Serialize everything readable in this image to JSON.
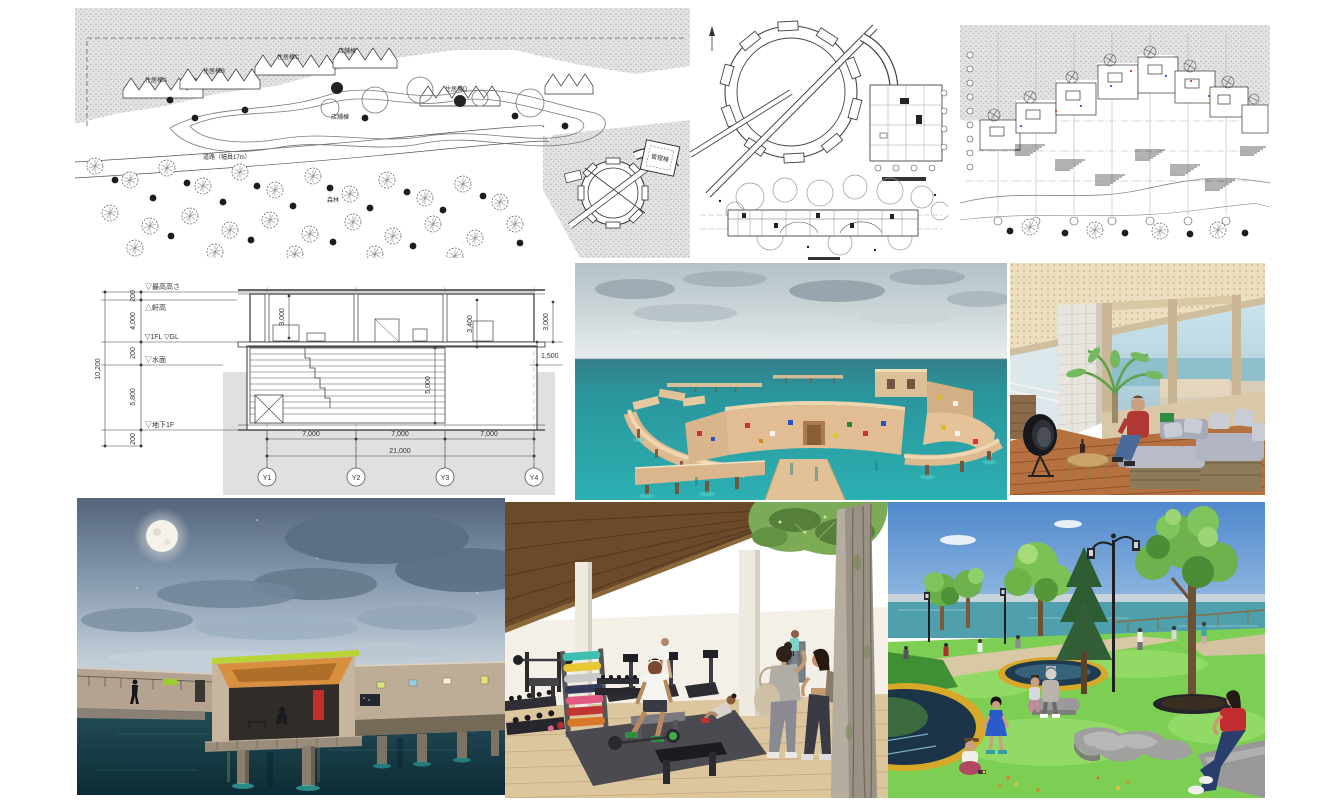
{
  "palette": {
    "sea_teal": "#2aa7ab",
    "night_water": "#123b44",
    "roof_lime": "#b9d437",
    "roof_orange": "#d89040",
    "grass_green": "#7ccf52",
    "drawing_ink": "#333333",
    "ground_gray": "#e0e0e0"
  },
  "site_plan": {
    "labels": {
      "building_a": "住居棟A",
      "building_b": "住居棟B",
      "building_c": "住居棟C",
      "building_d": "住居棟D",
      "shop": "店舗棟",
      "shop2": "店舗棟",
      "road": "道路（幅員17m）",
      "forest": "森林",
      "admin": "管理棟"
    }
  },
  "section": {
    "levels": {
      "max_height": "▽最高高さ",
      "eave": "△軒高",
      "first_floor": "▽1FL ▽GL",
      "water": "▽水面",
      "basement": "▽地下1F"
    },
    "dims": {
      "left_chain": [
        "200",
        "4,000",
        "200",
        "5,800",
        "200"
      ],
      "overall_height": "10,200",
      "room_height": "3,000",
      "story": "3,400",
      "parapet": "3,000",
      "freeboard": "1,500",
      "pool_depth": "5,000",
      "bays": [
        "7,000",
        "7,000",
        "7,000"
      ],
      "overall_width": "21,000"
    },
    "grid": [
      "Y1",
      "Y2",
      "Y3",
      "Y4"
    ]
  }
}
